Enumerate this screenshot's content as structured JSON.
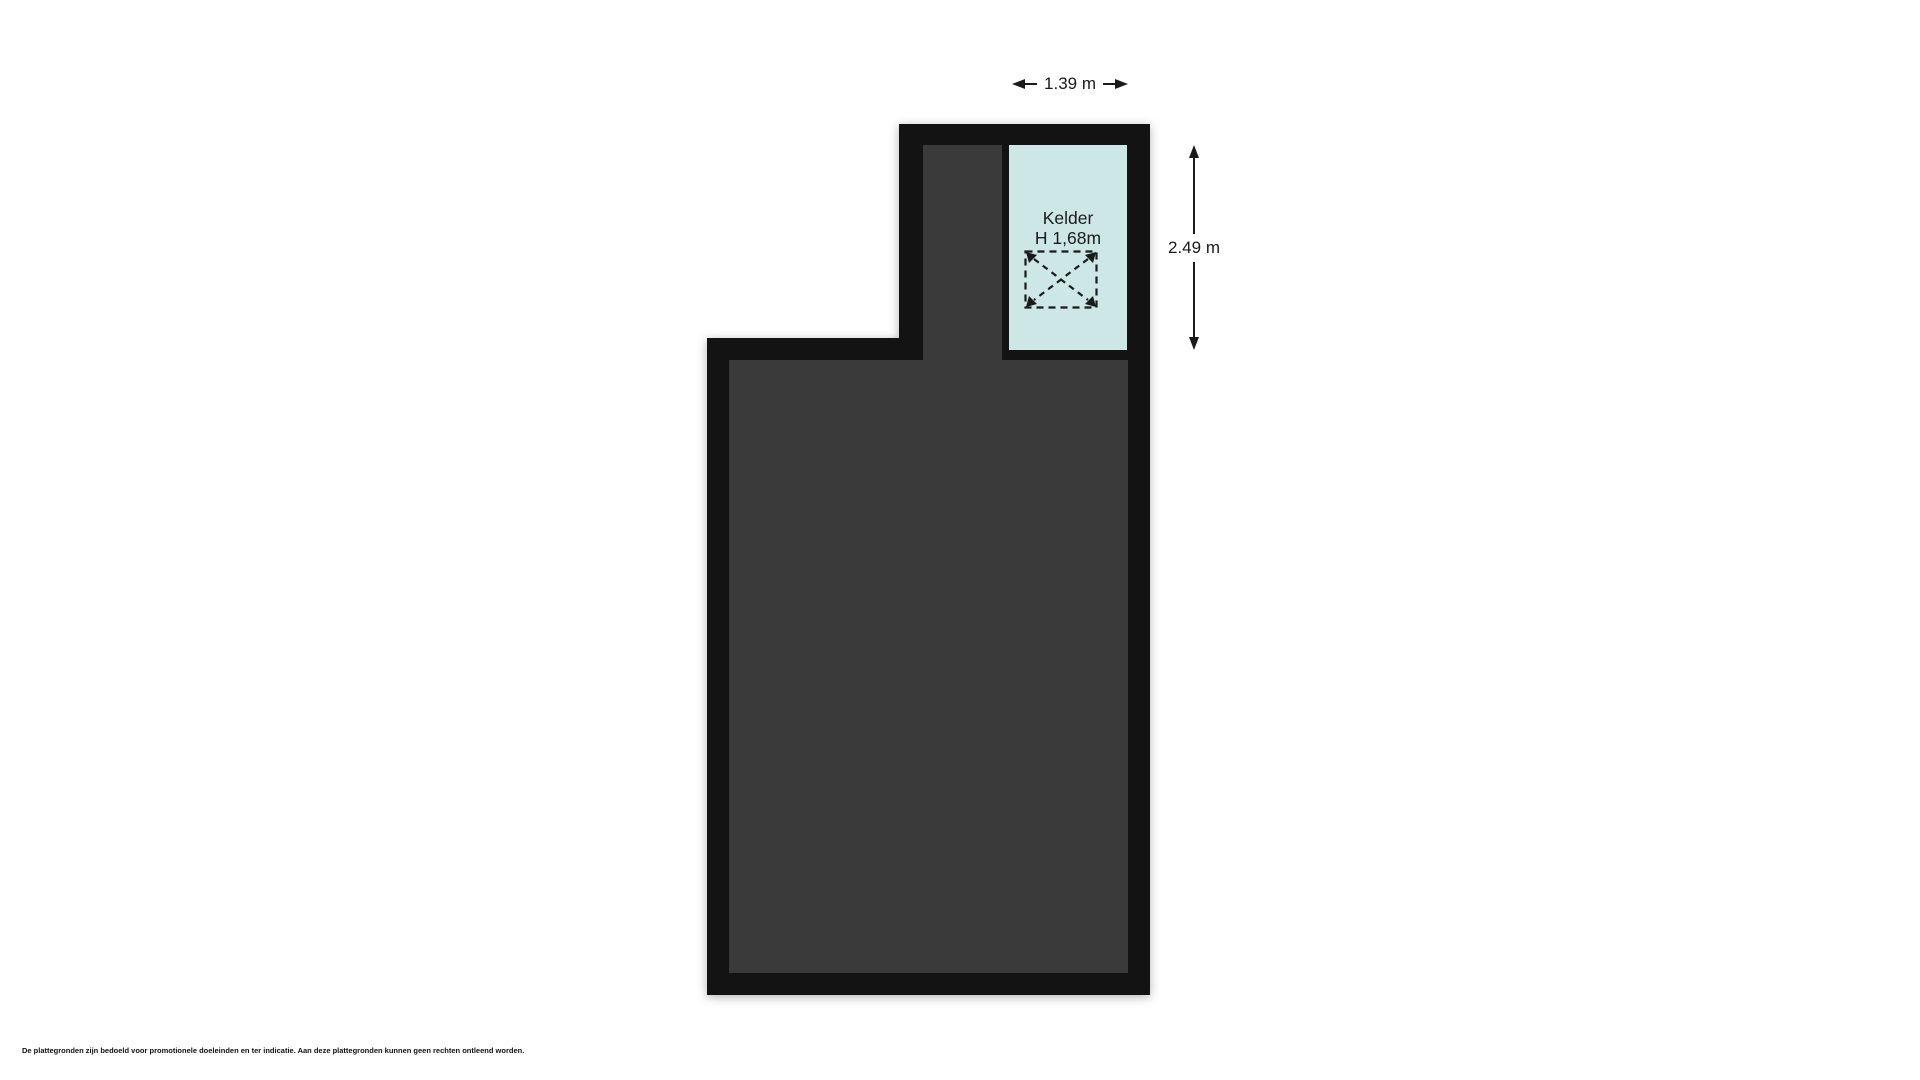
{
  "page": {
    "background_color": "#ffffff",
    "disclaimer": "De plattegronden zijn bedoeld voor promotionele doeleinden en ter indicatie. Aan deze plattegronden kunnen geen rechten ontleend worden."
  },
  "floorplan": {
    "colors": {
      "wall": "#131313",
      "interior": "#3a3a3a",
      "room_fill": "#cce7e6",
      "dimension": "#1a1a1a"
    },
    "rooms": [
      {
        "label": "Kelder",
        "height_label": "H 1,68m",
        "symbol": "dashed-cross-void"
      }
    ],
    "dimensions": [
      {
        "label": "1.39 m",
        "orientation": "horizontal",
        "position": "top"
      },
      {
        "label": "2.49 m",
        "orientation": "vertical",
        "position": "right"
      }
    ]
  }
}
